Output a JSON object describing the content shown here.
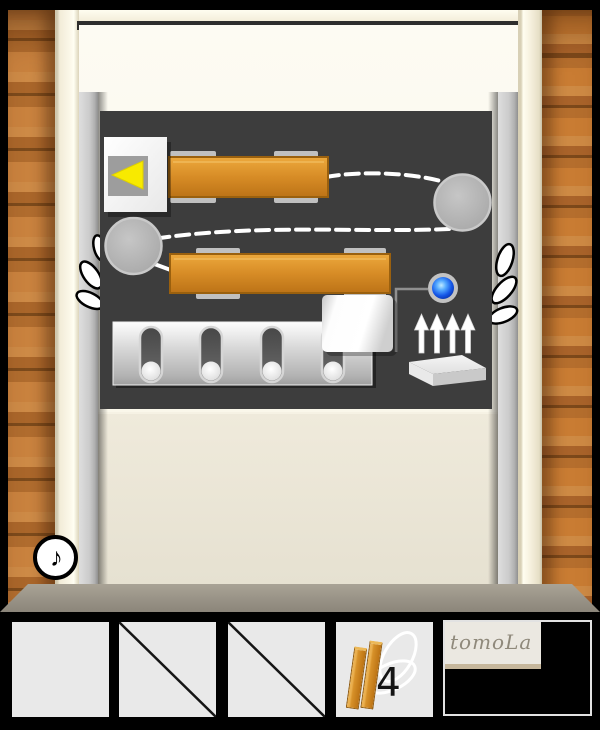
{
  "scene": {
    "type": "escape-room door puzzle",
    "brand": "tomoLa"
  },
  "hud": {
    "sound_button_char": "♪"
  },
  "panel": {
    "elements": [
      {
        "name": "arrow-button",
        "icon": "left-triangle",
        "color": "#f8ea00"
      },
      {
        "name": "slider-bar-top",
        "color": "#d78c26"
      },
      {
        "name": "slider-bar-bottom",
        "color": "#d78c26"
      },
      {
        "name": "pulley-left"
      },
      {
        "name": "pulley-right"
      },
      {
        "name": "rope",
        "style": "white dashed"
      },
      {
        "name": "blue-button",
        "color": "#1557e8"
      },
      {
        "name": "paper-box",
        "color": "#ffffff"
      },
      {
        "name": "pin-slot-panel",
        "pin_count": 4
      },
      {
        "name": "up-arrows",
        "arrow_count": 4
      },
      {
        "name": "platform-block"
      }
    ]
  },
  "inventory": {
    "slots": [
      {
        "id": "slot-1",
        "state": "empty"
      },
      {
        "id": "slot-2",
        "state": "crossed-out"
      },
      {
        "id": "slot-3",
        "state": "crossed-out"
      },
      {
        "id": "slot-4",
        "state": "item",
        "item": "wooden-planks",
        "count": "4"
      },
      {
        "id": "slot-logo",
        "state": "logo",
        "label": "tomoLa"
      }
    ]
  },
  "colors": {
    "wood_wall": "#b8743a",
    "panel_board": "#3d3d3d",
    "bar_orange": "#d78c26",
    "arrow_yellow": "#f8ea00",
    "button_blue": "#1557e8",
    "rope_white": "#ffffff",
    "frame_cream": "#f5efdc",
    "floor_gray": "#9a948a"
  }
}
